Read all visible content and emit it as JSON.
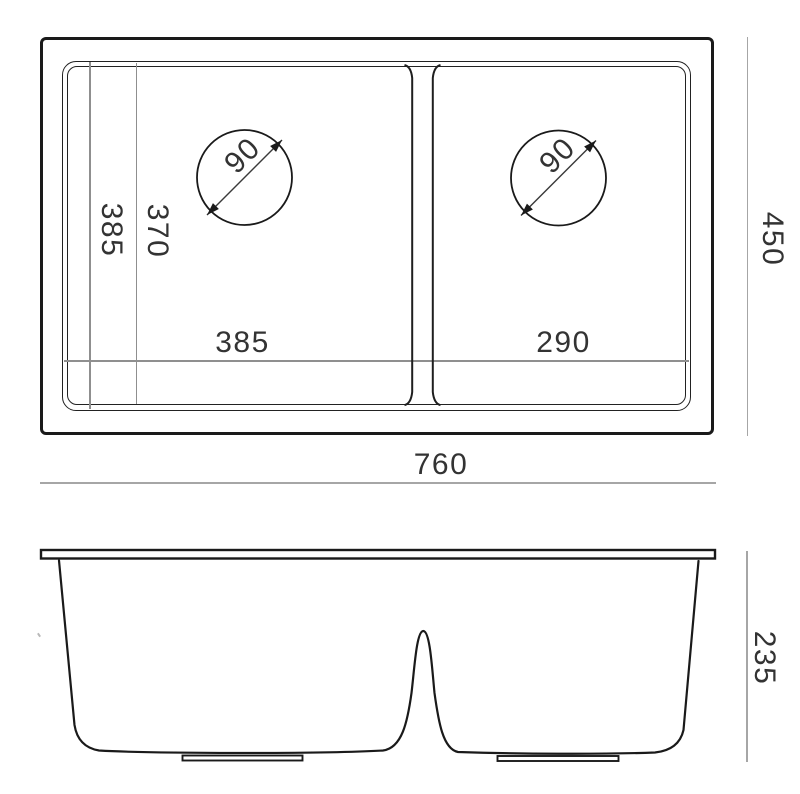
{
  "drawing": {
    "kind": "double-bowl-sink-technical-drawing",
    "views": {
      "top": {
        "overall_width_mm": "760",
        "overall_depth_mm": "450",
        "left_bowl": {
          "outer_span_mm": "385",
          "inner_span_mm": "370",
          "width_mm": "385",
          "drain_diameter_mm": "90"
        },
        "right_bowl": {
          "width_mm": "290",
          "drain_diameter_mm": "90"
        }
      },
      "front": {
        "height_mm": "235"
      }
    }
  },
  "colors": {
    "outline": "#1a1a1a",
    "dimension_line": "#a6a6a6",
    "reference_line": "#8f8f8f",
    "label_text": "#333333",
    "background": "#ffffff"
  }
}
